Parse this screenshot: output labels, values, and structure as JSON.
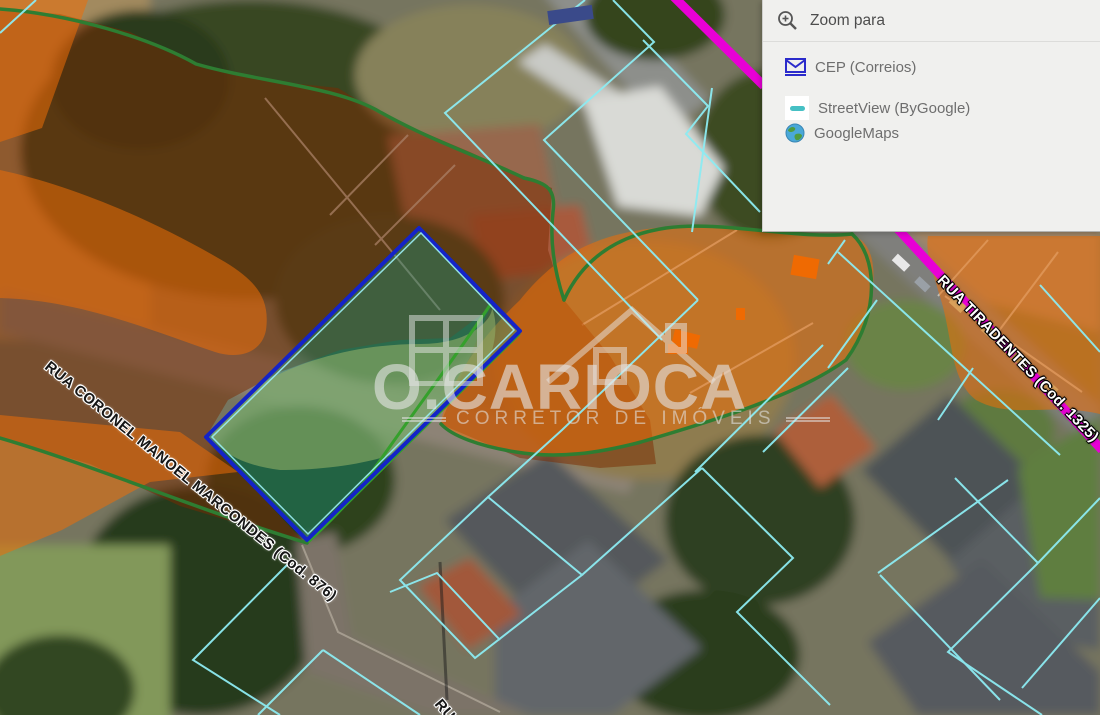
{
  "panel": {
    "search": {
      "icon": "zoom-in-magnifier-icon",
      "placeholder": "Zoom para"
    },
    "results": [
      {
        "icon": "envelope-icon",
        "label": "CEP (Correios)"
      },
      {
        "icon": "streetview-dash-icon",
        "label": "StreetView (ByGoogle)"
      },
      {
        "icon": "globe-icon",
        "label": "GoogleMaps"
      }
    ]
  },
  "map": {
    "street_labels": [
      {
        "name": "RUA CORONEL MANOEL MARCONDES (Cod. 876)"
      },
      {
        "name": "RUA TIRADENTES (Cod. 1325)"
      },
      {
        "name": "RU"
      }
    ],
    "watermark": {
      "title": "O.CARIOCA",
      "subtitle": "CORRETOR DE IMÓVEIS"
    },
    "colors": {
      "flood_zone_dark": "#7a2a00",
      "flood_zone_orange": "#ec6e08",
      "wetland_tan": "#d2af50",
      "parcel_line_cyan": "#8debf2",
      "selection_border_blue": "#1423c8",
      "selection_fill_teal": "#0aaa96",
      "highlight_road_magenta": "#e800d6",
      "zone_boundary_green": "#2e7d32",
      "creek_green": "#35a02c"
    }
  }
}
